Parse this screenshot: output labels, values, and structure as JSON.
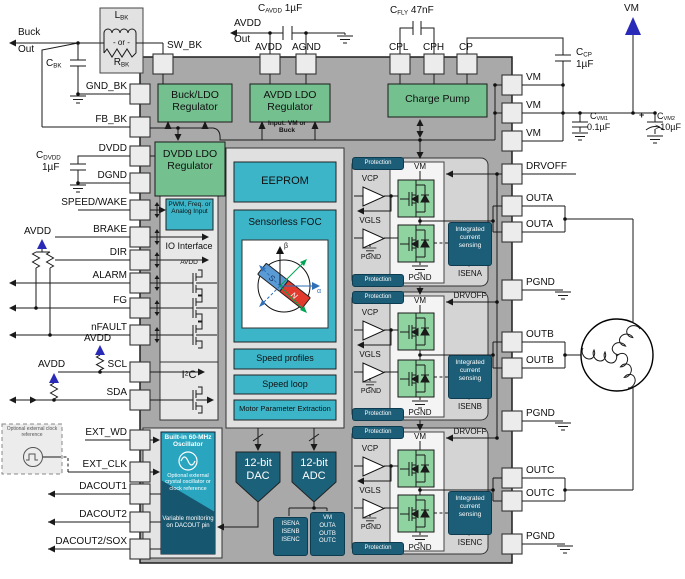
{
  "colors": {
    "ic_gray": "#a9a9a9",
    "container_gray": "#e3e3e3",
    "phase_gray": "#d4d4d4",
    "green": "#74c08f",
    "cyan": "#3cb5c9",
    "teal_dark": "#1c5d77",
    "teal_mid": "#2aa5c0",
    "fet_green": "#8fd3a0",
    "blue_accent": "#2a2ab8",
    "magnet_red": "#e23b2e",
    "magnet_blue": "#5b9bd5"
  },
  "pins": {
    "left": [
      "GND_BK",
      "FB_BK",
      "DVDD",
      "DGND",
      "SPEED/WAKE",
      "BRAKE",
      "DIR",
      "ALARM",
      "FG",
      "nFAULT",
      "SCL",
      "SDA",
      "EXT_WD",
      "EXT_CLK",
      "DACOUT1",
      "DACOUT2",
      "DACOUT2/SOX"
    ],
    "top": [
      "SW_BK",
      "AVDD",
      "AGND",
      "CPL",
      "CPH",
      "CP"
    ],
    "right": [
      "VM",
      "VM",
      "VM",
      "DRVOFF",
      "OUTA",
      "OUTA",
      "PGND",
      "OUTB",
      "OUTB",
      "PGND",
      "OUTC",
      "OUTC",
      "PGND"
    ]
  },
  "blocks": {
    "buck_ldo": "Buck/LDO Regulator",
    "avdd_ldo": "AVDD LDO Regulator",
    "input_note": "Input: VM or Buck",
    "charge_pump": "Charge Pump",
    "dvdd_ldo": "DVDD LDO Regulator",
    "eeprom": "EEPROM",
    "foc": "Sensorless FOC",
    "speed_profiles": "Speed profiles",
    "speed_loop": "Speed loop",
    "motor_param": "Motor Parameter Extraction",
    "pwm": "PWM, Freq. or Analog Input",
    "io": "IO Interface",
    "io_avdd": "AVDD",
    "i2c": {
      "pre": "I",
      "sup": "2",
      "post": "C"
    },
    "osc_title": "Built-in 60-MHz Oscillator",
    "osc_note": "Optional external crystal oscillator or clock reference",
    "osc_monitor": "Variable monitoring on DACOUT pin",
    "dac": "12-bit DAC",
    "adc": "12-bit ADC",
    "adc_src_isen": "ISENA\nISENB\nISENC",
    "adc_src_vm": "VM\nOUTA\nOUTB\nOUTC"
  },
  "phase": {
    "protection": "Protection",
    "vm": "VM",
    "vcp": "VCP",
    "vgls": "VGLS",
    "pgnd": "PGND",
    "sensing": "Integrated\ncurrent\nsensing",
    "isena": "ISENA",
    "isenb": "ISENB",
    "isenc": "ISENC",
    "drvoff": "DRVOFF"
  },
  "external": {
    "buck": "Buck",
    "out": "Out",
    "avdd": "AVDD",
    "vm": "VM",
    "lbk": {
      "sym": "L",
      "sub": "BK"
    },
    "rbk": {
      "sym": "R",
      "sub": "BK"
    },
    "or_label": "- or -",
    "cbk": {
      "sym": "C",
      "sub": "BK"
    },
    "cavdd": {
      "sym": "C",
      "sub": "AVDD",
      "val": "1µF"
    },
    "cfly": {
      "sym": "C",
      "sub": "FLY",
      "val": "47nF"
    },
    "ccp": {
      "sym": "C",
      "sub": "CP",
      "val": "1µF"
    },
    "cvm1": {
      "sym": "C",
      "sub": "VM1",
      "val": "0.1µF"
    },
    "cvm2": {
      "sym": "C",
      "sub": "VM2",
      "val": ">10µF",
      "plus": "+"
    },
    "cdvdd": {
      "sym": "C",
      "sub": "DVDD",
      "val": "1µF"
    },
    "clock_ref": "Optional external clock reference"
  },
  "foc": {
    "alpha": "α",
    "beta": "β",
    "s": "S",
    "n": "N"
  }
}
